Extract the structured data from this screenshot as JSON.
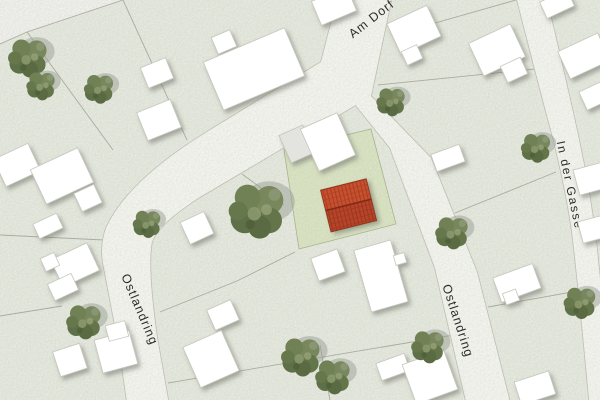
{
  "map": {
    "type": "site-plan",
    "street_labels": {
      "am_dorf": "Am Dorf",
      "ostlandring_west": "Ostlandring",
      "ostlandring_east": "Ostlandring",
      "in_der_gasse": "In der Gasse"
    },
    "highlight": {
      "description": "red-roofed building on green parcel",
      "roof_color": "#c24d2e",
      "roof_ridge_color": "#7e2812",
      "parcel_color": "#dce6c5"
    },
    "colors": {
      "background": "#e8ebe1",
      "street_fill": "#f7f7f2",
      "street_casing": "#c1c1b7",
      "parcel_line": "#abada2",
      "building_fill": "#ffffff",
      "building_outline": "#c6c6bd",
      "building_annex": "#e3e4df",
      "tree_green": "#6d7d52",
      "label_text": "#2d2d2a"
    },
    "symbols": {
      "tree_count": 13
    }
  }
}
